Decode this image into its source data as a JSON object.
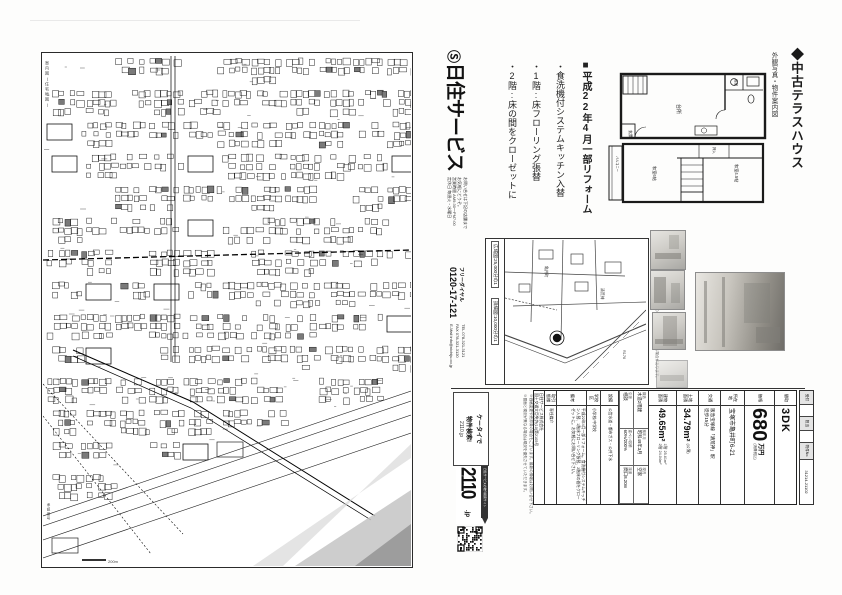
{
  "map_page": {
    "side_label": "案内図(住宅地図)",
    "bottom_note": "承認番号",
    "scale_label": "200m"
  },
  "flyer": {
    "title_main": "◆中古テラスハウス",
    "title_sub": "外観写真・物件案内図",
    "renovation": {
      "heading": "■平成22年4月一部リフォーム",
      "items": [
        "・食洗機付システムキッチン入替",
        "・1階:床フローリング張替",
        "・2階:床の間をクローゼットに"
      ]
    },
    "floorplan": {
      "f1_rooms": [
        "玄関",
        "台所",
        "浴室",
        "洗面"
      ],
      "f2_rooms": [
        "和室6帖",
        "和室4.5帖",
        "押入",
        "バルコニー"
      ]
    },
    "company": {
      "mark": "Ⓢ",
      "name": "日住サービス",
      "print1": "お問い合せは下記の店舗まで",
      "print2": "お気軽にどうぞ。",
      "print3": "営業時間 AM9:30〜PM7:00",
      "print4": "定休日 毎週火・水曜日",
      "freedial_label": "フリーダイヤル",
      "freedial": "0120-17-121",
      "tel": "TEL 078-321-3121",
      "fax": "FAX 078-321-3120",
      "mail": "E-Mail info@nichiju.co.jp"
    },
    "map_box": {
      "scale1": "広域図:25,000分の1",
      "scale2": "詳細図:10,000分の1",
      "note": "※この案内図は住宅地図を基に作成したもので、実際とは多少異なる場合があります。",
      "labels": [
        "亀井町",
        "清荒神",
        "R176"
      ]
    },
    "disclaimer": {
      "line1": "※価格変更や売却済の場合もございます。最新の情報はお問い合せ下さい。",
      "line2": "※図面と現況が異なる場合は現況を優先させていただきます。"
    },
    "listing": {
      "madori_label": "間取",
      "madori": "3DK",
      "price_label": "価格",
      "price": "680",
      "price_unit": "万円",
      "price_note": "(消費税込)",
      "addr_label": "所在地",
      "addr": "宝塚市亀井町6-21",
      "access_label": "交通",
      "access1": "阪急宝塚線「清荒神」駅",
      "access2": "徒歩15分",
      "land_label": "土地面積",
      "land": "34.79m²",
      "land_note": "(公簿)",
      "bldg_label": "建物面積",
      "bldg": "49.65m²",
      "bldg1": "1階 25.61m²",
      "bldg2": "2階 24.04m²",
      "cells": [
        {
          "label": "構造",
          "value": "木造2階建"
        },
        {
          "label": "築年月",
          "value": "昭和49年3月"
        },
        {
          "label": "現況",
          "value": "空家"
        },
        {
          "label": "引渡",
          "value": "相談"
        },
        {
          "label": "建ぺい/容積",
          "value": "60%/200%"
        },
        {
          "label": "接道",
          "value": "間口8.20m"
        }
      ],
      "setsubi_label": "設備",
      "setsubi": "公営水道・都市ガス・公共下水",
      "school_label": "学校区",
      "school": "小学校/中学校",
      "biko_label": "備考",
      "biko": "平成22年4月一部リフォーム。食洗機付システムキッチン入替、1階床フローリング張替、2階床の間をクローゼットに。お気軽にお問い合せ下さい。",
      "torihiki_label": "取引態様",
      "torihiki": "専任媒介",
      "company_line1": "日住サービス株式会社",
      "company_line2": "国土交通大臣免許(10)第2105号"
    },
    "badge": {
      "catch1": "ケータイで",
      "catch2": "物件検索!",
      "site_small": "2110.jp",
      "num": "2110",
      "tld": ".jp",
      "banner": "日住サービスの物件検索サイト"
    },
    "ref": {
      "l1": "受付",
      "l2": "担当",
      "l3": "物件No.",
      "number": "31214-21102"
    }
  }
}
